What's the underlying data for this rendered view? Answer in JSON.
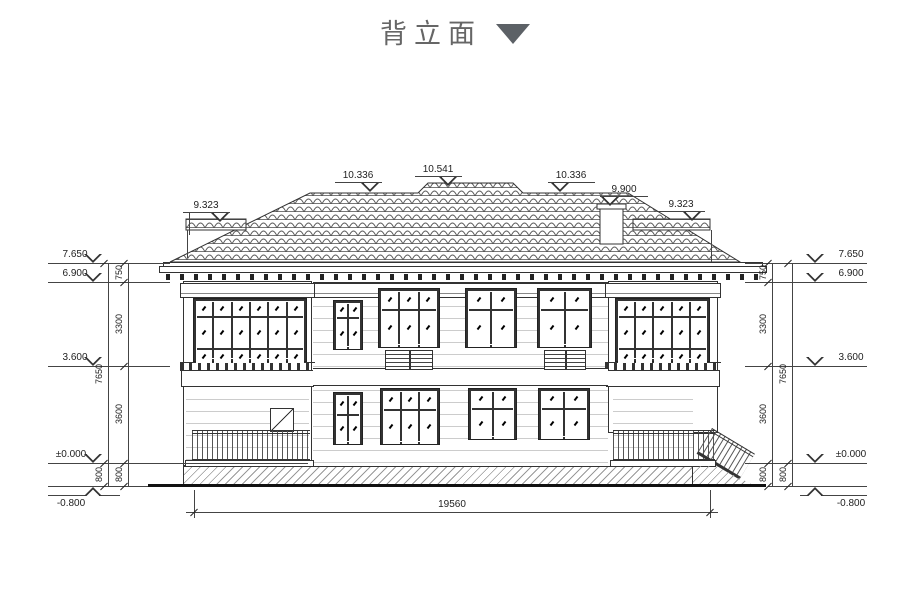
{
  "title": {
    "text": "背立面"
  },
  "roof_marks": {
    "left_wing": "9.323",
    "left_main": "10.336",
    "center": "10.541",
    "right_main": "10.336",
    "chimney": "9.900",
    "right_wing": "9.323"
  },
  "elevations": {
    "left": [
      "7.650",
      "6.900",
      "3.600",
      "±0.000",
      "-0.800"
    ],
    "right": [
      "7.650",
      "6.900",
      "3.600",
      "±0.000",
      "-0.800"
    ]
  },
  "dims": {
    "left_inner": [
      "750",
      "3300",
      "3600",
      "800"
    ],
    "left_outer": [
      "7650",
      "800"
    ],
    "right_inner": [
      "750",
      "3300",
      "3600",
      "800"
    ],
    "right_outer": [
      "7650",
      "800"
    ],
    "overall": "19560"
  }
}
